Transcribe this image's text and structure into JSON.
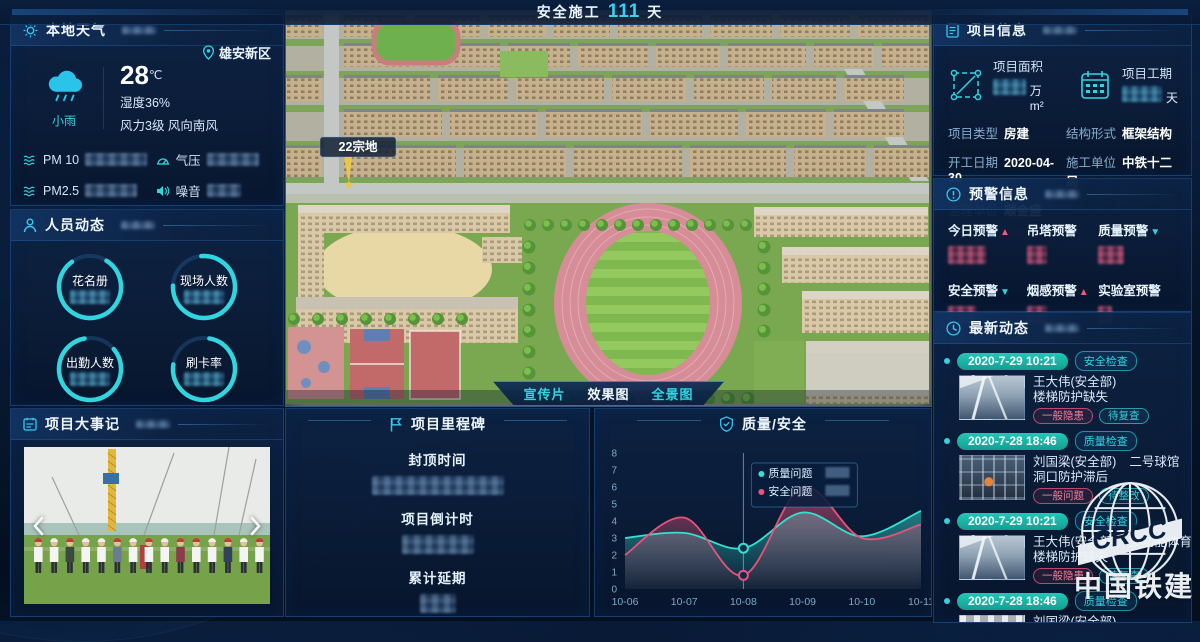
{
  "header": {
    "prefix": "安全施工",
    "days": "111",
    "suffix": "天"
  },
  "scene": {
    "plot_label": "22宗地",
    "tabs": [
      {
        "label": "宣传片"
      },
      {
        "label": "效果图"
      },
      {
        "label": "全景图"
      }
    ]
  },
  "weather": {
    "title": "本地天气",
    "location": "雄安新区",
    "condition": "小雨",
    "temperature": "28",
    "temp_unit": "℃",
    "humidity": "湿度36%",
    "wind": "风力3级 风向南风",
    "metrics": [
      {
        "label": "PM 10"
      },
      {
        "label": "气压"
      },
      {
        "label": "PM2.5"
      },
      {
        "label": "噪音"
      }
    ]
  },
  "personnel": {
    "title": "人员动态",
    "gauges": [
      {
        "label": "花名册"
      },
      {
        "label": "现场人数"
      },
      {
        "label": "出勤人数"
      },
      {
        "label": "刷卡率"
      }
    ]
  },
  "events": {
    "title": "项目大事记"
  },
  "milestone": {
    "title": "项目里程碑",
    "items": [
      {
        "label": "封顶时间"
      },
      {
        "label": "项目倒计时"
      },
      {
        "label": "累计延期"
      }
    ]
  },
  "quality": {
    "title": "质量/安全"
  },
  "chart_data": {
    "type": "area",
    "title": "质量/安全",
    "x": [
      "10-06",
      "10-07",
      "10-08",
      "10-09",
      "10-10",
      "10-11"
    ],
    "series": [
      {
        "name": "质量问题",
        "color": "#35e0d0",
        "values": [
          3.0,
          3.3,
          2.4,
          4.5,
          3.1,
          4.6
        ]
      },
      {
        "name": "安全问题",
        "color": "#e8537a",
        "values": [
          2.0,
          4.2,
          0.8,
          6.0,
          3.0,
          3.8
        ]
      }
    ],
    "ylim": [
      0,
      8
    ],
    "ytick_step": 1,
    "grid": false,
    "legend_position": "tooltip",
    "highlight_x": "10-08"
  },
  "project_info": {
    "title": "项目信息",
    "stats": [
      {
        "label": "项目面积",
        "unit": "万m²"
      },
      {
        "label": "项目工期",
        "unit": "天"
      }
    ],
    "fields": [
      {
        "label": "项目类型",
        "value": "房建"
      },
      {
        "label": "结构形式",
        "value": "框架结构"
      },
      {
        "label": "开工日期",
        "value": "2020-04-30"
      },
      {
        "label": "施工单位",
        "value": "中铁十二局"
      },
      {
        "label": "监理单位",
        "value": "顺金盛"
      }
    ]
  },
  "warnings": {
    "title": "预警信息",
    "items": [
      {
        "label": "今日预警",
        "arrow": "▲",
        "trend": "up"
      },
      {
        "label": "吊塔预警",
        "arrow": "",
        "trend": "none"
      },
      {
        "label": "质量预警",
        "arrow": "▼",
        "trend": "down"
      },
      {
        "label": "安全预警",
        "arrow": "▼",
        "trend": "down"
      },
      {
        "label": "烟感预警",
        "arrow": "▲",
        "trend": "up"
      },
      {
        "label": "实验室预警",
        "arrow": "",
        "trend": "none"
      }
    ]
  },
  "updates": {
    "title": "最新动态",
    "entries": [
      {
        "time": "2020-7-29 10:21",
        "type": "安全检查",
        "name": "王大伟(安全部)",
        "location": "",
        "issue": "楼梯防护缺失",
        "tags": [
          "一般隐患",
          "待复查"
        ]
      },
      {
        "time": "2020-7-28 18:46",
        "type": "质量检查",
        "name": "刘国梁(安全部)",
        "location": "二号球馆",
        "issue": "洞口防护滞后",
        "tags": [
          "一般问题",
          "待整改"
        ]
      },
      {
        "time": "2020-7-29 10:21",
        "type": "安全检查",
        "name": "王大伟(安全部)",
        "location": "多功能体育馆",
        "issue": "楼梯防护缺失",
        "tags": [
          "一般隐患",
          "待复查"
        ]
      },
      {
        "time": "2020-7-28 18:46",
        "type": "质量检查",
        "name": "刘国梁(安全部)",
        "location": "",
        "issue": "",
        "tags": []
      }
    ]
  },
  "logo": {
    "abbr": "CRCC",
    "name": "中国铁建"
  }
}
